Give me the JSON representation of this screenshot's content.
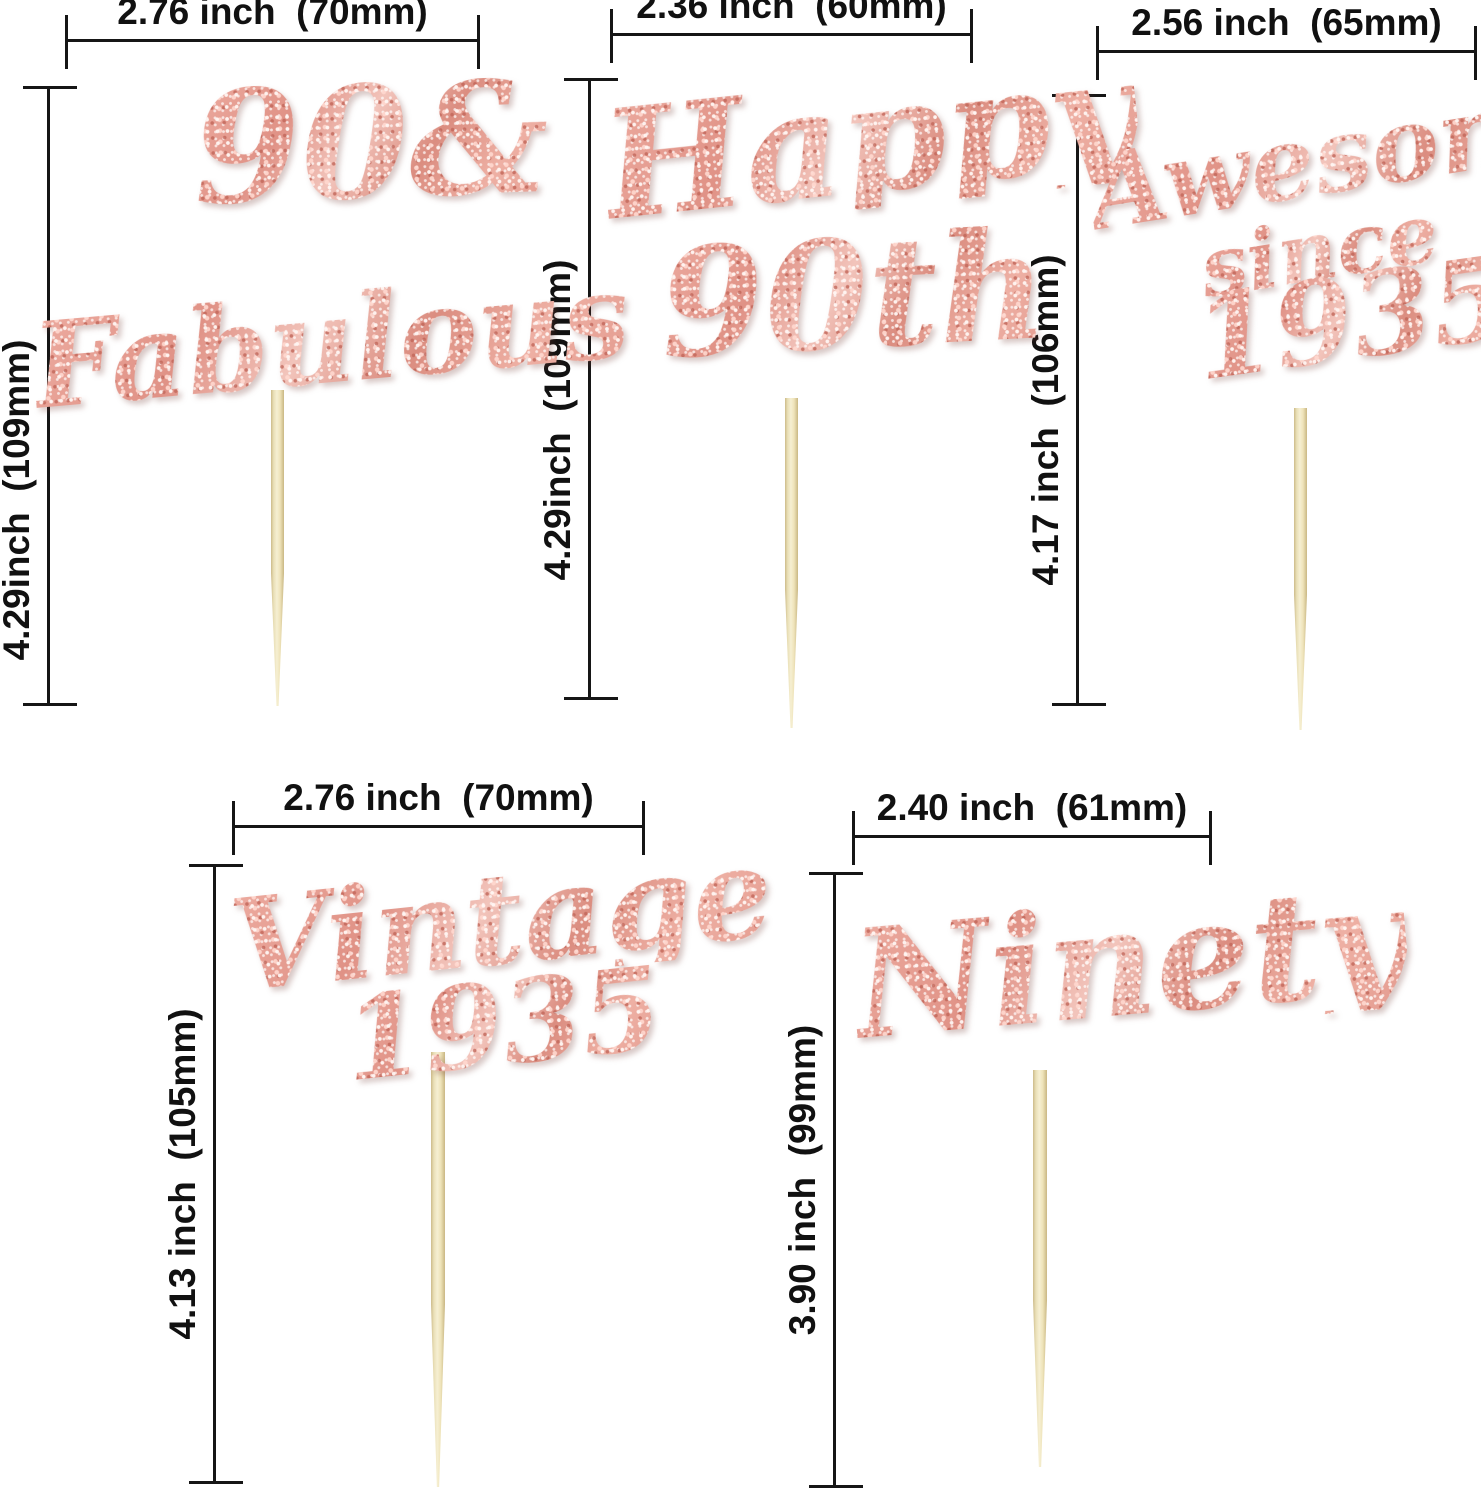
{
  "page": {
    "background": "#ffffff"
  },
  "colors": {
    "dimension_line": "#161616",
    "label_text": "#111111",
    "glitter_rose_gold": "#e29a8f",
    "glitter_highlight": "#f2c4bb",
    "glitter_shadow": "#c16558",
    "stick_wood_light": "#f6efd2",
    "stick_wood_dark": "#cdbb8a"
  },
  "toppers": [
    {
      "name": "90 & Fabulous cake topper",
      "lines": [
        "90&",
        "Fabulous"
      ],
      "width_label": "2.76 inch  (70mm)",
      "height_label": "4.29inch  (109mm)"
    },
    {
      "name": "Happy 90th cake topper",
      "lines": [
        "Happy",
        "90th"
      ],
      "width_label": "2.36 inch  (60mm)",
      "height_label": "4.29inch  (109mm)"
    },
    {
      "name": "Awesome since 1935 cake topper",
      "lines": [
        "Awesome",
        "since",
        "1935"
      ],
      "width_label": "2.56 inch  (65mm)",
      "height_label": "4.17 inch  (106mm)"
    },
    {
      "name": "Vintage 1935 cake topper",
      "lines": [
        "Vintage",
        "1935"
      ],
      "width_label": "2.76 inch  (70mm)",
      "height_label": "4.13 inch  (105mm)"
    },
    {
      "name": "Ninety cake topper",
      "lines": [
        "Ninety"
      ],
      "width_label": "2.40 inch  (61mm)",
      "height_label": "3.90 inch  (99mm)"
    }
  ]
}
